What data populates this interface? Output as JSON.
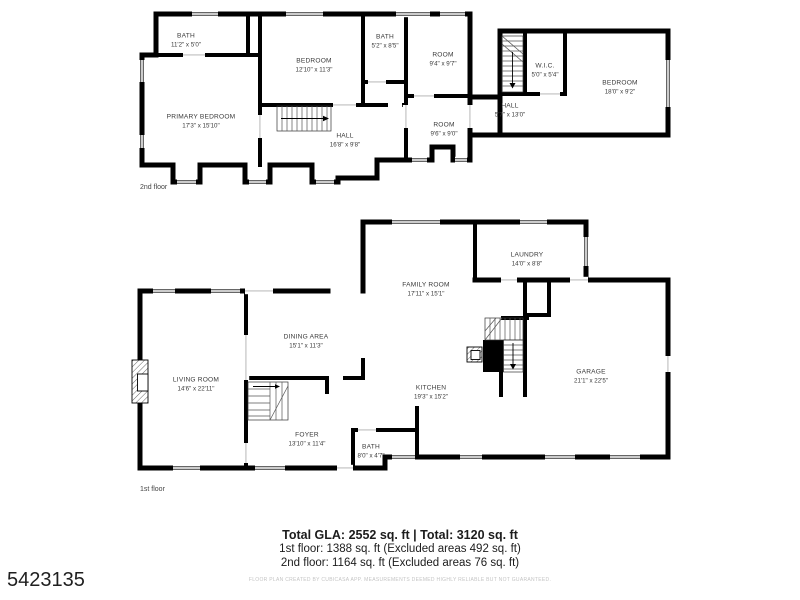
{
  "page": {
    "listing_id": "5423135"
  },
  "floors": [
    {
      "name": "2nd floor",
      "rooms": [
        {
          "label": "BATH",
          "dims": "11'2\" x 5'0\""
        },
        {
          "label": "BEDROOM",
          "dims": "12'10\" x 11'3\""
        },
        {
          "label": "BATH",
          "dims": "5'2\" x 8'5\""
        },
        {
          "label": "ROOM",
          "dims": "9'4\" x 9'7\""
        },
        {
          "label": "PRIMARY BEDROOM",
          "dims": "17'3\" x 15'10\""
        },
        {
          "label": "HALL",
          "dims": "16'8\" x 9'8\""
        },
        {
          "label": "ROOM",
          "dims": "9'6\" x 9'0\""
        },
        {
          "label": "HALL",
          "dims": "5'7\" x 13'0\""
        },
        {
          "label": "W.I.C.",
          "dims": "5'0\" x 5'4\""
        },
        {
          "label": "BEDROOM",
          "dims": "18'0\" x 9'2\""
        }
      ]
    },
    {
      "name": "1st floor",
      "rooms": [
        {
          "label": "FAMILY ROOM",
          "dims": "17'11\" x 15'1\""
        },
        {
          "label": "LAUNDRY",
          "dims": "14'0\" x 8'8\""
        },
        {
          "label": "LIVING ROOM",
          "dims": "14'6\" x 22'11\""
        },
        {
          "label": "DINING AREA",
          "dims": "15'1\" x 11'3\""
        },
        {
          "label": "KITCHEN",
          "dims": "19'3\" x 15'2\""
        },
        {
          "label": "GARAGE",
          "dims": "21'1\" x 22'5\""
        },
        {
          "label": "FOYER",
          "dims": "13'10\" x 11'4\""
        },
        {
          "label": "BATH",
          "dims": "8'0\" x 4'7\""
        }
      ]
    }
  ],
  "summary": {
    "total_line": "Total GLA: 2552 sq. ft | Total: 3120 sq. ft",
    "first_floor_line": "1st floor: 1388 sq. ft (Excluded areas 492 sq. ft)",
    "second_floor_line": "2nd floor: 1164 sq. ft (Excluded areas 76 sq. ft)",
    "disclaimer": "FLOOR PLAN CREATED BY CUBICASA APP. MEASUREMENTS DEEMED HIGHLY RELIABLE BUT NOT GUARANTEED."
  },
  "colors": {
    "wall": "#000000",
    "label": "#3a3a3a",
    "disclaimer": "#c4c4c4"
  }
}
